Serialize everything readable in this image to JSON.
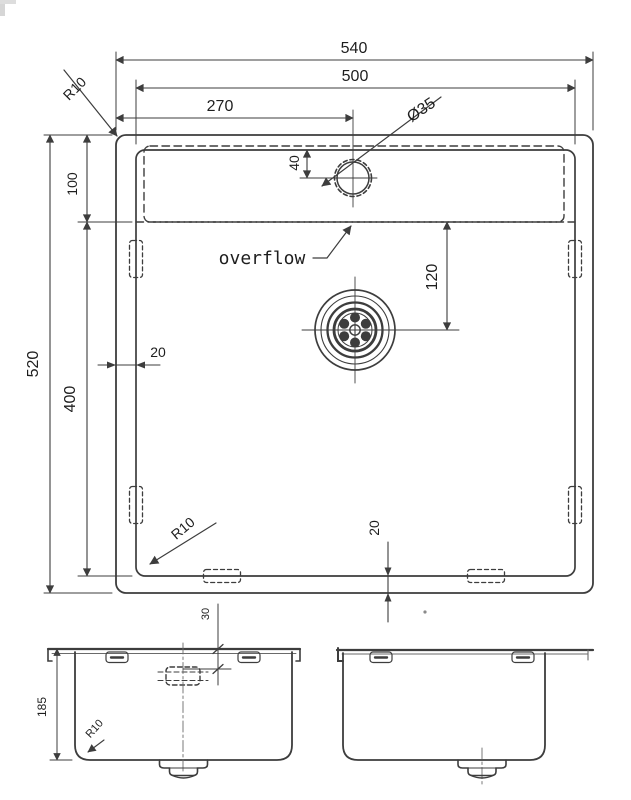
{
  "drawing": {
    "kind": "sink-dimension-drawing",
    "colors": {
      "line": "#3d3d3d",
      "thin_line": "#5a5a5a",
      "text": "#1e1e1e",
      "background": "#ffffff"
    },
    "plan": {
      "dim_overall_width": "540",
      "dim_bowl_width": "500",
      "dim_faucet_center_from_left": "270",
      "dim_faucet_hole_diameter": "Ø35",
      "radius_rim_corner": "R10",
      "dim_rim_to_overflow": "100",
      "dim_overall_depth": "520",
      "dim_overflow_to_bowl_bottom": "400",
      "dim_wall_thickness_side": "20",
      "dim_wall_thickness_bottom": "20",
      "dim_overflow_to_drain": "120",
      "dim_hole_from_rim": "40",
      "radius_bowl_corner": "R10",
      "label_overflow": "overflow"
    },
    "front_view": {
      "dim_bowl_depth": "185",
      "dim_overflow_from_rim": "30",
      "radius_bottom_corner": "R10"
    }
  }
}
